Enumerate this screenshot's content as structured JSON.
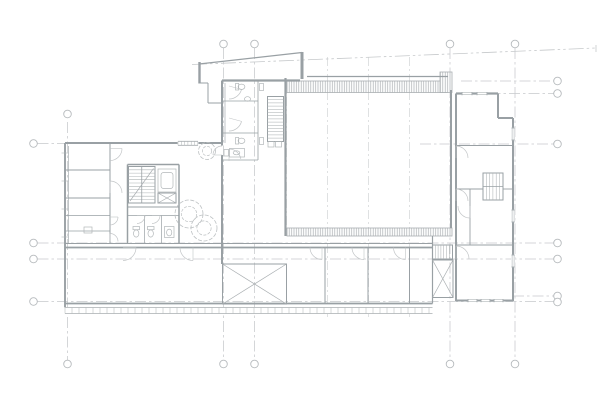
{
  "canvas": {
    "w": 600,
    "h": 400,
    "bg": "#ffffff"
  },
  "palette": {
    "wall": "#99a0a4",
    "grid": "#c6c9cb",
    "light": "#ced1d3",
    "hatch": "#a9aeb1",
    "detail": "#aeb3b5",
    "door": "#c2c5c7",
    "fixture": "#b2b7b9",
    "plant": "#bcc0c2",
    "marker": "#b6babd"
  },
  "plan": {
    "grid_lines": [
      {
        "x1": 67.5,
        "y1": 122,
        "x2": 67.5,
        "y2": 360,
        "k": "grid"
      },
      {
        "x1": 223.5,
        "y1": 48,
        "x2": 223.5,
        "y2": 360,
        "k": "grid"
      },
      {
        "x1": 254.5,
        "y1": 48,
        "x2": 254.5,
        "y2": 360,
        "k": "grid"
      },
      {
        "x1": 450,
        "y1": 48,
        "x2": 450,
        "y2": 360,
        "k": "grid"
      },
      {
        "x1": 515,
        "y1": 48,
        "x2": 515,
        "y2": 360,
        "k": "grid"
      },
      {
        "x1": 286.5,
        "y1": 80,
        "x2": 286.5,
        "y2": 236,
        "k": "light"
      },
      {
        "x1": 327.5,
        "y1": 57,
        "x2": 327.5,
        "y2": 317,
        "k": "light"
      },
      {
        "x1": 368.5,
        "y1": 57,
        "x2": 368.5,
        "y2": 317,
        "k": "light"
      },
      {
        "x1": 409.5,
        "y1": 57,
        "x2": 409.5,
        "y2": 317,
        "k": "light"
      },
      {
        "x1": 37.5,
        "y1": 143.5,
        "x2": 80,
        "y2": 143.5,
        "k": "grid"
      },
      {
        "x1": 420,
        "y1": 144,
        "x2": 553.5,
        "y2": 144,
        "k": "grid"
      },
      {
        "x1": 461,
        "y1": 81,
        "x2": 553.5,
        "y2": 81,
        "k": "grid"
      },
      {
        "x1": 470,
        "y1": 93.5,
        "x2": 553.5,
        "y2": 93.5,
        "k": "grid"
      },
      {
        "x1": 37.5,
        "y1": 243,
        "x2": 553.5,
        "y2": 243,
        "k": "grid"
      },
      {
        "x1": 37.5,
        "y1": 259,
        "x2": 553.5,
        "y2": 259,
        "k": "grid"
      },
      {
        "x1": 37.5,
        "y1": 301.5,
        "x2": 553.5,
        "y2": 301.5,
        "k": "grid"
      },
      {
        "x1": 513,
        "y1": 296,
        "x2": 553.5,
        "y2": 296,
        "k": "grid"
      }
    ],
    "grid_circles": [
      {
        "cx": 67.5,
        "cy": 114
      },
      {
        "cx": 223.5,
        "cy": 44
      },
      {
        "cx": 254.5,
        "cy": 44
      },
      {
        "cx": 450,
        "cy": 44
      },
      {
        "cx": 515,
        "cy": 44
      },
      {
        "cx": 67.5,
        "cy": 364
      },
      {
        "cx": 223.5,
        "cy": 364
      },
      {
        "cx": 254.5,
        "cy": 364
      },
      {
        "cx": 450,
        "cy": 364
      },
      {
        "cx": 515,
        "cy": 364
      },
      {
        "cx": 33.5,
        "cy": 143.5
      },
      {
        "cx": 33.5,
        "cy": 243
      },
      {
        "cx": 33.5,
        "cy": 259
      },
      {
        "cx": 33.5,
        "cy": 301.5
      },
      {
        "cx": 557.5,
        "cy": 81
      },
      {
        "cx": 557.5,
        "cy": 93.5
      },
      {
        "cx": 557.5,
        "cy": 144
      },
      {
        "cx": 557.5,
        "cy": 243
      },
      {
        "cx": 557.5,
        "cy": 259
      },
      {
        "cx": 557.5,
        "cy": 296
      },
      {
        "cx": 557.5,
        "cy": 302
      }
    ],
    "ref_line": {
      "x1": 192,
      "y1": 64.5,
      "x2": 596,
      "y2": 48,
      "tick_x": 596,
      "tick_y1": 45,
      "tick_y2": 52
    },
    "hatch_rects": [
      {
        "x": 287,
        "y": 81,
        "w": 160,
        "h": 11.5
      },
      {
        "x": 440,
        "y": 72,
        "w": 12,
        "h": 20.5
      },
      {
        "x": 287,
        "y": 228,
        "w": 165,
        "h": 8
      }
    ],
    "walls": [
      {
        "x1": 65,
        "y1": 143,
        "x2": 65,
        "y2": 307.5,
        "w": 1.9
      },
      {
        "x1": 68.5,
        "y1": 146,
        "x2": 68.5,
        "y2": 243.5,
        "w": 0.6
      },
      {
        "x1": 65,
        "y1": 143,
        "x2": 222,
        "y2": 143,
        "w": 1.9
      },
      {
        "x1": 110,
        "y1": 143,
        "x2": 110,
        "y2": 243.5,
        "w": 1
      },
      {
        "x1": 65,
        "y1": 170,
        "x2": 110,
        "y2": 170,
        "w": 0.9
      },
      {
        "x1": 65,
        "y1": 198,
        "x2": 110,
        "y2": 198,
        "w": 0.9
      },
      {
        "x1": 65,
        "y1": 215.5,
        "x2": 110,
        "y2": 215.5,
        "w": 0.8
      },
      {
        "x1": 65,
        "y1": 231,
        "x2": 110,
        "y2": 231,
        "w": 0.8
      },
      {
        "x1": 127.5,
        "y1": 164.5,
        "x2": 179,
        "y2": 164.5,
        "w": 1.5
      },
      {
        "x1": 127.5,
        "y1": 164.5,
        "x2": 127.5,
        "y2": 243.5,
        "w": 1.5
      },
      {
        "x1": 179,
        "y1": 164.5,
        "x2": 179,
        "y2": 243.5,
        "w": 1.5
      },
      {
        "x1": 127.5,
        "y1": 207,
        "x2": 179,
        "y2": 207,
        "w": 1
      },
      {
        "x1": 127.5,
        "y1": 215.5,
        "x2": 179,
        "y2": 215.5,
        "w": 0.7
      },
      {
        "x1": 144.5,
        "y1": 215.5,
        "x2": 144.5,
        "y2": 243.5,
        "w": 0.7
      },
      {
        "x1": 161.5,
        "y1": 215.5,
        "x2": 161.5,
        "y2": 243.5,
        "w": 0.7
      },
      {
        "x1": 65,
        "y1": 243.5,
        "x2": 432.5,
        "y2": 243.5,
        "w": 1.1
      },
      {
        "x1": 65,
        "y1": 247.5,
        "x2": 432.5,
        "y2": 247.5,
        "w": 1.8
      },
      {
        "x1": 222,
        "y1": 80.5,
        "x2": 222,
        "y2": 145.5,
        "w": 2
      },
      {
        "x1": 222,
        "y1": 155,
        "x2": 222,
        "y2": 264,
        "w": 2
      },
      {
        "x1": 225,
        "y1": 83,
        "x2": 225,
        "y2": 143,
        "w": 0.6
      },
      {
        "x1": 222,
        "y1": 80.5,
        "x2": 300,
        "y2": 80.5,
        "w": 2.2
      },
      {
        "x1": 222,
        "y1": 101,
        "x2": 258,
        "y2": 101,
        "w": 0.8
      },
      {
        "x1": 222,
        "y1": 133,
        "x2": 258,
        "y2": 133,
        "w": 0.8
      },
      {
        "x1": 258,
        "y1": 80.5,
        "x2": 258,
        "y2": 160,
        "w": 0.8
      },
      {
        "x1": 222,
        "y1": 160,
        "x2": 258,
        "y2": 160,
        "w": 0.8
      },
      {
        "x1": 199.5,
        "y1": 62,
        "x2": 199.5,
        "y2": 83.5,
        "w": 2.4
      },
      {
        "x1": 302,
        "y1": 52,
        "x2": 302,
        "y2": 79,
        "w": 3
      },
      {
        "x1": 199,
        "y1": 83,
        "x2": 208,
        "y2": 83,
        "w": 1
      },
      {
        "x1": 208,
        "y1": 83,
        "x2": 208,
        "y2": 103,
        "w": 1
      },
      {
        "x1": 208,
        "y1": 103,
        "x2": 222,
        "y2": 103,
        "w": 1
      },
      {
        "x1": 199,
        "y1": 64,
        "x2": 302,
        "y2": 52.5,
        "w": 1.2
      },
      {
        "x1": 285.5,
        "y1": 78,
        "x2": 285.5,
        "y2": 236,
        "w": 2.2
      },
      {
        "x1": 307,
        "y1": 76.5,
        "x2": 448,
        "y2": 76.5,
        "w": 1.3
      },
      {
        "x1": 451,
        "y1": 90,
        "x2": 451,
        "y2": 228,
        "w": 2
      },
      {
        "x1": 432.5,
        "y1": 236,
        "x2": 432.5,
        "y2": 303.5,
        "w": 1.2
      },
      {
        "x1": 456,
        "y1": 93.5,
        "x2": 456,
        "y2": 301,
        "w": 2
      },
      {
        "x1": 456,
        "y1": 93.5,
        "x2": 498,
        "y2": 93.5,
        "w": 2.2
      },
      {
        "x1": 498,
        "y1": 93.5,
        "x2": 498,
        "y2": 118,
        "w": 2
      },
      {
        "x1": 498,
        "y1": 118,
        "x2": 513,
        "y2": 118,
        "w": 2
      },
      {
        "x1": 513,
        "y1": 118,
        "x2": 513,
        "y2": 301,
        "w": 2
      },
      {
        "x1": 456,
        "y1": 145.5,
        "x2": 513,
        "y2": 145.5,
        "w": 1.1
      },
      {
        "x1": 456,
        "y1": 189,
        "x2": 483,
        "y2": 189,
        "w": 0.9
      },
      {
        "x1": 503,
        "y1": 189,
        "x2": 513,
        "y2": 189,
        "w": 0.9
      },
      {
        "x1": 470,
        "y1": 189,
        "x2": 470,
        "y2": 245,
        "w": 0.9
      },
      {
        "x1": 456,
        "y1": 245,
        "x2": 513,
        "y2": 245,
        "w": 1.1
      },
      {
        "x1": 456,
        "y1": 300.5,
        "x2": 513,
        "y2": 300.5,
        "w": 2
      },
      {
        "x1": 325,
        "y1": 247.5,
        "x2": 325,
        "y2": 303.5,
        "w": 1
      },
      {
        "x1": 368,
        "y1": 247.5,
        "x2": 368,
        "y2": 303.5,
        "w": 1
      },
      {
        "x1": 409.5,
        "y1": 247.5,
        "x2": 409.5,
        "y2": 303.5,
        "w": 1
      },
      {
        "x1": 65,
        "y1": 303.5,
        "x2": 432.5,
        "y2": 303.5,
        "w": 1.8
      },
      {
        "x1": 222.5,
        "y1": 247.5,
        "x2": 222.5,
        "y2": 264,
        "w": 1
      }
    ],
    "xboxes": [
      {
        "x": 222.5,
        "y": 264,
        "w": 64,
        "h": 40
      },
      {
        "x": 432.5,
        "y": 260,
        "w": 20.5,
        "h": 37.5
      },
      {
        "x": 158,
        "y": 193,
        "w": 18,
        "h": 10
      }
    ],
    "stairs": [
      {
        "x": 128.5,
        "y": 166.5,
        "w": 26.5,
        "h": 36.5,
        "dir": "v",
        "step": 3.3,
        "divider": true,
        "diag": true
      },
      {
        "x": 267.5,
        "y": 96.5,
        "w": 16,
        "h": 45,
        "dir": "v",
        "step": 3.2,
        "divider": false,
        "diag": false
      },
      {
        "x": 483,
        "y": 173,
        "w": 20,
        "h": 27,
        "dir": "h",
        "step": 3.3,
        "divider": true,
        "diag": false
      },
      {
        "x": 432.5,
        "y": 245,
        "w": 20,
        "h": 14,
        "dir": "h",
        "step": 2.8,
        "divider": false,
        "diag": false
      }
    ],
    "doors": [
      {
        "cx": 110,
        "cy": 148.5,
        "r": 12,
        "a1": 0,
        "a2": 90
      },
      {
        "cx": 110,
        "cy": 193,
        "r": 12,
        "a1": 270,
        "a2": 360
      },
      {
        "cx": 110,
        "cy": 217,
        "r": 8,
        "a1": 0,
        "a2": 90
      },
      {
        "cx": 110,
        "cy": 241.5,
        "r": 8,
        "a1": 270,
        "a2": 360
      },
      {
        "cx": 137,
        "cy": 215.5,
        "r": 8,
        "a1": 0,
        "a2": 90
      },
      {
        "cx": 152,
        "cy": 215.5,
        "r": 8,
        "a1": 0,
        "a2": 90
      },
      {
        "cx": 229,
        "cy": 86,
        "r": 13,
        "a1": 15,
        "a2": 90
      },
      {
        "cx": 229,
        "cy": 118,
        "r": 13,
        "a1": 15,
        "a2": 90
      },
      {
        "cx": 229,
        "cy": 161,
        "r": 12,
        "a1": 270,
        "a2": 350
      },
      {
        "cx": 222,
        "cy": 155,
        "r": 9,
        "a1": 180,
        "a2": 270
      },
      {
        "cx": 322,
        "cy": 247.5,
        "r": 12,
        "a1": 90,
        "a2": 180
      },
      {
        "cx": 364,
        "cy": 247.5,
        "r": 12,
        "a1": 90,
        "a2": 180
      },
      {
        "cx": 405.5,
        "cy": 247.5,
        "r": 12,
        "a1": 90,
        "a2": 180
      },
      {
        "cx": 193,
        "cy": 247.5,
        "r": 13,
        "a1": 90,
        "a2": 180
      },
      {
        "cx": 123,
        "cy": 247.5,
        "r": 13,
        "a1": 0,
        "a2": 90
      },
      {
        "cx": 456,
        "cy": 158,
        "r": 12,
        "a1": 270,
        "a2": 360
      },
      {
        "cx": 456,
        "cy": 201,
        "r": 12,
        "a1": 270,
        "a2": 360
      },
      {
        "cx": 470,
        "cy": 206,
        "r": 12,
        "a1": 90,
        "a2": 180
      },
      {
        "cx": 456,
        "cy": 259,
        "r": 13,
        "a1": 270,
        "a2": 360
      }
    ],
    "windows": [
      {
        "x": 462,
        "y": 92,
        "w": 10,
        "h": 3.2
      },
      {
        "x": 477,
        "y": 92,
        "w": 10,
        "h": 3.2
      },
      {
        "x": 511.5,
        "y": 128,
        "w": 3.2,
        "h": 12
      },
      {
        "x": 511.5,
        "y": 210,
        "w": 3.2,
        "h": 12
      },
      {
        "x": 511.5,
        "y": 255,
        "w": 3.2,
        "h": 12
      },
      {
        "x": 468,
        "y": 299,
        "w": 9,
        "h": 3.2
      },
      {
        "x": 481,
        "y": 299,
        "w": 9,
        "h": 3.2
      },
      {
        "x": 494,
        "y": 299,
        "w": 9,
        "h": 3.2
      }
    ],
    "combs": [
      {
        "x": 65,
        "y": 307.5,
        "w": 367.5,
        "h": 6,
        "step": 7
      },
      {
        "x": 178,
        "y": 141.3,
        "w": 20,
        "h": 4,
        "step": 3.3
      }
    ],
    "plants": [
      {
        "cx": 189,
        "cy": 214,
        "r": 14
      },
      {
        "cx": 204,
        "cy": 228,
        "r": 13
      },
      {
        "cx": 207,
        "cy": 151,
        "r": 8.5
      }
    ],
    "fixture_rects": [
      {
        "x": 84,
        "y": 227,
        "w": 8,
        "h": 6
      },
      {
        "x": 224,
        "y": 149.5,
        "w": 4.5,
        "h": 6.5
      },
      {
        "x": 229.5,
        "y": 148.5,
        "w": 15,
        "h": 8.5
      },
      {
        "x": 259.5,
        "y": 83.5,
        "w": 4,
        "h": 7
      },
      {
        "x": 259.5,
        "y": 137.5,
        "w": 4,
        "h": 7
      },
      {
        "x": 235.5,
        "y": 83.5,
        "w": 3.2,
        "h": 6.5
      },
      {
        "x": 235.5,
        "y": 137.5,
        "w": 3.2,
        "h": 6.5
      },
      {
        "x": 133,
        "y": 226.5,
        "w": 6.5,
        "h": 3.2
      },
      {
        "x": 147.5,
        "y": 226.5,
        "w": 6.5,
        "h": 3.2
      },
      {
        "x": 164.5,
        "y": 226.5,
        "w": 9.5,
        "h": 11
      },
      {
        "x": 268,
        "y": 141.5,
        "w": 6,
        "h": 5.5
      },
      {
        "x": 275.5,
        "y": 141.5,
        "w": 6,
        "h": 5.5
      },
      {
        "x": 158,
        "y": 169,
        "w": 18,
        "h": 23,
        "rx": 0
      },
      {
        "x": 161,
        "y": 172.5,
        "w": 12,
        "h": 16,
        "rx": 2.5
      }
    ],
    "fixture_ellipses": [
      {
        "cx": 241.5,
        "cy": 86.8,
        "rx": 3.4,
        "ry": 2.7
      },
      {
        "cx": 241.5,
        "cy": 140.8,
        "rx": 3.4,
        "ry": 2.7
      },
      {
        "cx": 136.2,
        "cy": 233.5,
        "rx": 2.7,
        "ry": 3.6
      },
      {
        "cx": 150.7,
        "cy": 233.5,
        "rx": 2.7,
        "ry": 3.6
      },
      {
        "cx": 247.5,
        "cy": 99,
        "rx": 3,
        "ry": 2.3
      },
      {
        "cx": 236.5,
        "cy": 152.8,
        "rx": 3.3,
        "ry": 2
      },
      {
        "cx": 169.2,
        "cy": 232.5,
        "rx": 2.6,
        "ry": 3.4
      }
    ],
    "wall_ticks": [
      {
        "x1": 61.5,
        "y1": 153,
        "x2": 68.5,
        "y2": 153
      },
      {
        "x1": 61.5,
        "y1": 181,
        "x2": 68.5,
        "y2": 181
      },
      {
        "x1": 61.5,
        "y1": 209,
        "x2": 68.5,
        "y2": 209
      },
      {
        "x1": 61.5,
        "y1": 237,
        "x2": 68.5,
        "y2": 237
      }
    ]
  }
}
